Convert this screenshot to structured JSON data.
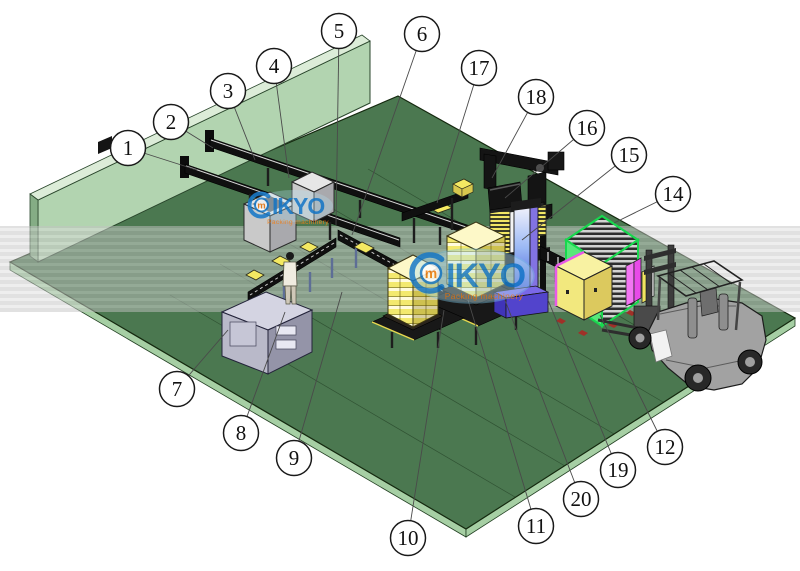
{
  "canvas": {
    "width": 800,
    "height": 571
  },
  "watermark": {
    "brand_m": "m",
    "brand_rest": "IKYO",
    "tagline": "Packing machinery",
    "blue": "#1879c8",
    "orange": "#f08018",
    "halo": "#b4dff0"
  },
  "palette": {
    "floor_green": "#4b7850",
    "wall_green": "#b2d4b0",
    "band_gray": "#c2c2c2",
    "box_yellow": "#f4e962",
    "magazine_green": "#57e87a",
    "magenta": "#e84ae8",
    "wrapper_blue": "#5244cc",
    "wrapper_purple": "#8273e2",
    "forklift_gray": "#a2a2a2"
  },
  "callouts": [
    {
      "n": "1",
      "x": 128,
      "y": 148,
      "tx": 197,
      "ty": 170
    },
    {
      "n": "2",
      "x": 171,
      "y": 122,
      "tx": 213,
      "ty": 148
    },
    {
      "n": "3",
      "x": 228,
      "y": 91,
      "tx": 255,
      "ty": 160
    },
    {
      "n": "4",
      "x": 274,
      "y": 66,
      "tx": 289,
      "ty": 178
    },
    {
      "n": "5",
      "x": 339,
      "y": 31,
      "tx": 336,
      "ty": 225
    },
    {
      "n": "6",
      "x": 422,
      "y": 34,
      "tx": 352,
      "ty": 235
    },
    {
      "n": "17",
      "x": 479,
      "y": 68,
      "tx": 437,
      "ty": 203
    },
    {
      "n": "18",
      "x": 536,
      "y": 97,
      "tx": 492,
      "ty": 178
    },
    {
      "n": "16",
      "x": 587,
      "y": 128,
      "tx": 505,
      "ty": 198
    },
    {
      "n": "15",
      "x": 629,
      "y": 155,
      "tx": 522,
      "ty": 240
    },
    {
      "n": "14",
      "x": 673,
      "y": 194,
      "tx": 614,
      "ty": 223
    },
    {
      "n": "7",
      "x": 177,
      "y": 389,
      "tx": 228,
      "ty": 330
    },
    {
      "n": "8",
      "x": 241,
      "y": 433,
      "tx": 285,
      "ty": 312
    },
    {
      "n": "9",
      "x": 294,
      "y": 458,
      "tx": 342,
      "ty": 292
    },
    {
      "n": "10",
      "x": 408,
      "y": 538,
      "tx": 444,
      "ty": 310
    },
    {
      "n": "11",
      "x": 536,
      "y": 526,
      "tx": 468,
      "ty": 300
    },
    {
      "n": "20",
      "x": 581,
      "y": 499,
      "tx": 505,
      "ty": 300
    },
    {
      "n": "19",
      "x": 618,
      "y": 470,
      "tx": 548,
      "ty": 300
    },
    {
      "n": "12",
      "x": 665,
      "y": 447,
      "tx": 600,
      "ty": 315
    }
  ]
}
